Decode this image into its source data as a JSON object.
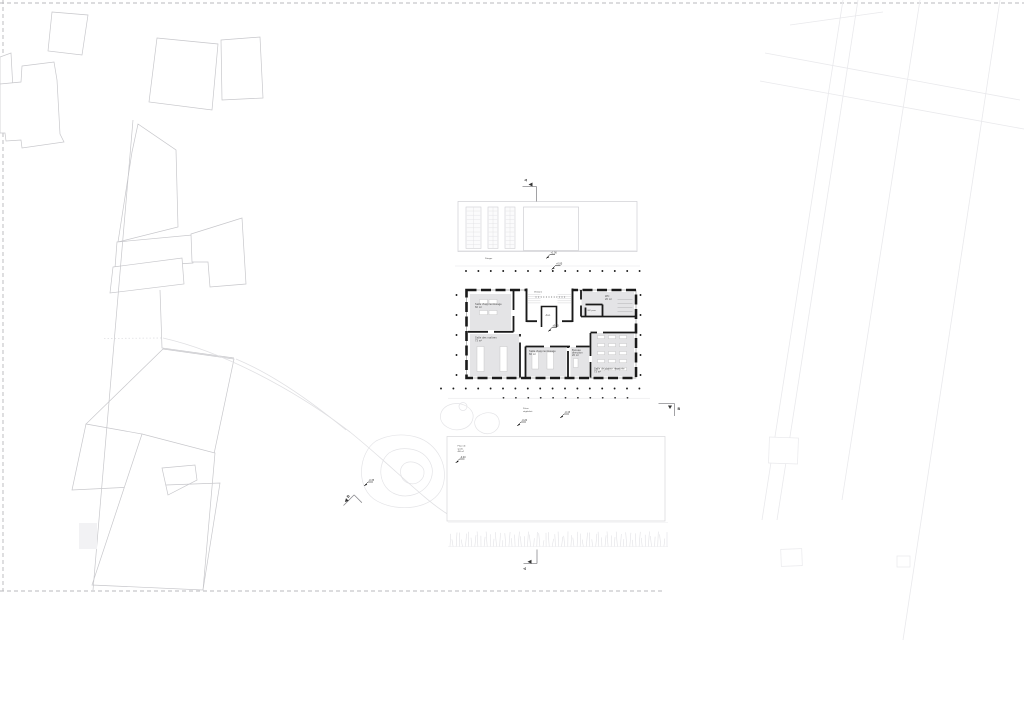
{
  "plan": {
    "rooms": {
      "apprentissage1": {
        "label": "Salle d'apprentissage",
        "area": "60 m²"
      },
      "maitres": {
        "label": "Salle des maîtres",
        "area": "73 m²"
      },
      "apprentissage2": {
        "label": "Salle d'apprentissage",
        "area": "60 m²"
      },
      "bureau": {
        "line1": "Bureau",
        "line2": "direction",
        "area": "20 m²"
      },
      "classe": {
        "label": "Salle de classe réservée",
        "area": "73 m²"
      },
      "wc": {
        "label": "WC",
        "area": "20 m²"
      },
      "wc_pers": {
        "label": "WC pers."
      },
      "ascenseur": {
        "label": "Asc."
      },
      "vestiaire": {
        "label": "Vestiaire"
      }
    },
    "site": {
      "potager": "Potager",
      "preau": {
        "line1": "Préau",
        "line2": "végétalisé"
      },
      "field": {
        "line1": "Place de",
        "line2": "sports",
        "line3": "480 m²"
      }
    },
    "levels": {
      "terrace_upper": "+1.00",
      "terrace_lower": "+0.85",
      "hall": "±0.00",
      "preau_east": "-0.15",
      "preau_west": "-0.20",
      "path": "-0.35",
      "field": "-0.40"
    },
    "sections": {
      "a": "A",
      "b": "B"
    },
    "colors": {
      "wall": "#1a1a1a",
      "room_fill": "#e4e4e6",
      "room_fill_light": "#ededef",
      "context_line": "#c7c7cb",
      "faint_line": "#e9e9ec",
      "dash_line": "#b8b8bc",
      "text": "#4a4a4a",
      "background": "#ffffff"
    }
  }
}
